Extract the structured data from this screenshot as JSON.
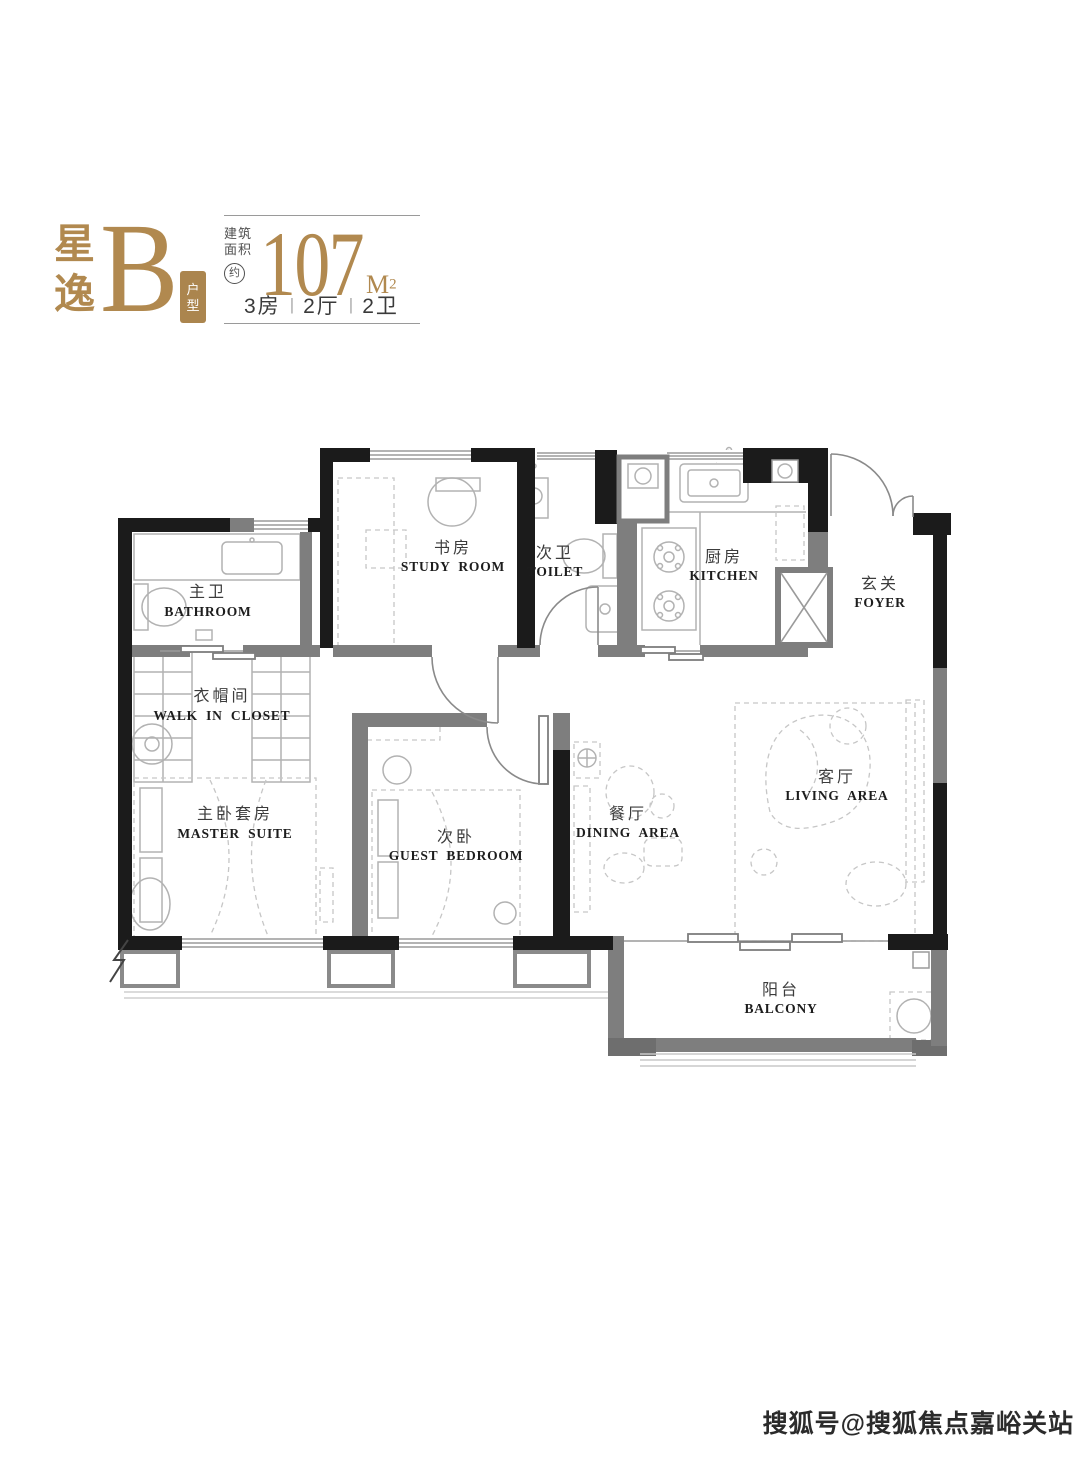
{
  "header": {
    "project_name_chars": [
      "星",
      "逸"
    ],
    "unit_letter": "B",
    "unit_type_chars": [
      "户",
      "型"
    ],
    "area_label_lines": [
      "建筑",
      "面积"
    ],
    "approx_label": "约",
    "area_value": "107",
    "area_unit_base": "M",
    "area_unit_exp": "2",
    "layout_summary": [
      "3房",
      "2厅",
      "2卫"
    ],
    "separator": "|"
  },
  "floorplan": {
    "rooms": [
      {
        "id": "bathroom",
        "cn": "主卫",
        "en": "BATHROOM"
      },
      {
        "id": "walk-in-closet",
        "cn": "衣帽间",
        "en": "WALK IN CLOSET"
      },
      {
        "id": "master-suite",
        "cn": "主卧套房",
        "en": "MASTER SUITE"
      },
      {
        "id": "study-room",
        "cn": "书房",
        "en": "STUDY ROOM"
      },
      {
        "id": "toilet",
        "cn": "次卫",
        "en": "TOILET"
      },
      {
        "id": "kitchen",
        "cn": "厨房",
        "en": "KITCHEN"
      },
      {
        "id": "foyer",
        "cn": "玄关",
        "en": "FOYER"
      },
      {
        "id": "guest-bedroom",
        "cn": "次卧",
        "en": "GUEST BEDROOM"
      },
      {
        "id": "dining-area",
        "cn": "餐厅",
        "en": "DINING AREA"
      },
      {
        "id": "living-area",
        "cn": "客厅",
        "en": "LIVING AREA"
      },
      {
        "id": "balcony",
        "cn": "阳台",
        "en": "BALCONY"
      }
    ]
  },
  "watermark": {
    "text": "搜狐号@搜狐焦点嘉峪关站"
  },
  "colors": {
    "gold": "#b1894f",
    "wall": "#1b1b1b",
    "partition": "#7e7e7e",
    "text_dark": "#3c3c3c"
  }
}
